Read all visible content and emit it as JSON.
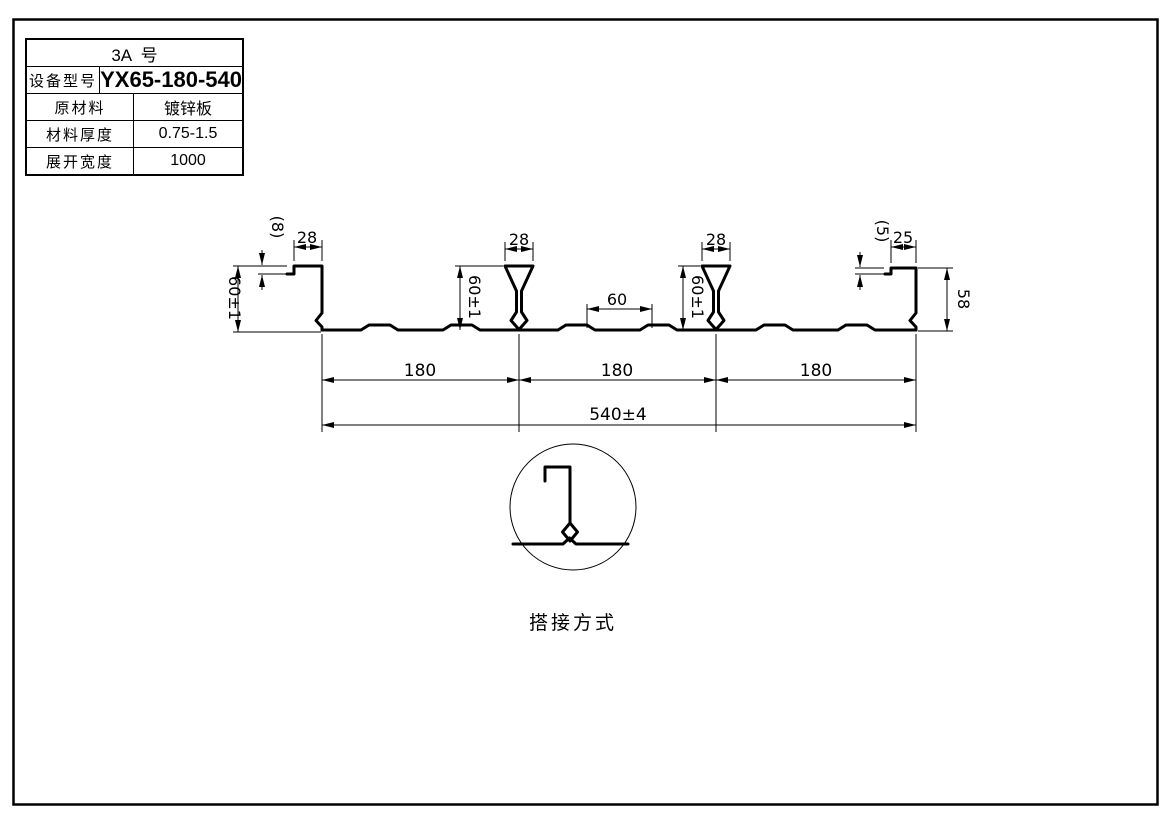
{
  "table": {
    "title": "3A  号",
    "rows": [
      {
        "label": "设备型号",
        "value": "YX65-180-540"
      },
      {
        "label": "原材料",
        "value": "镀锌板"
      },
      {
        "label": "材料厚度",
        "value": "0.75-1.5"
      },
      {
        "label": "展开宽度",
        "value": "1000"
      }
    ]
  },
  "dims": {
    "left_flange": "28",
    "left_lip": "(8)",
    "left_height": "60±1",
    "rib1_width": "28",
    "rib1_height": "60±1",
    "mid_spacing": "60",
    "rib2_width": "28",
    "rib2_height": "60±1",
    "right_lip": "(5)",
    "right_flange": "25",
    "right_height": "58",
    "pitches": [
      "180",
      "180",
      "180"
    ],
    "overall": "540±4"
  },
  "detail": {
    "caption": "搭接方式"
  },
  "colors": {
    "ink": "#000000",
    "paper": "#ffffff"
  }
}
